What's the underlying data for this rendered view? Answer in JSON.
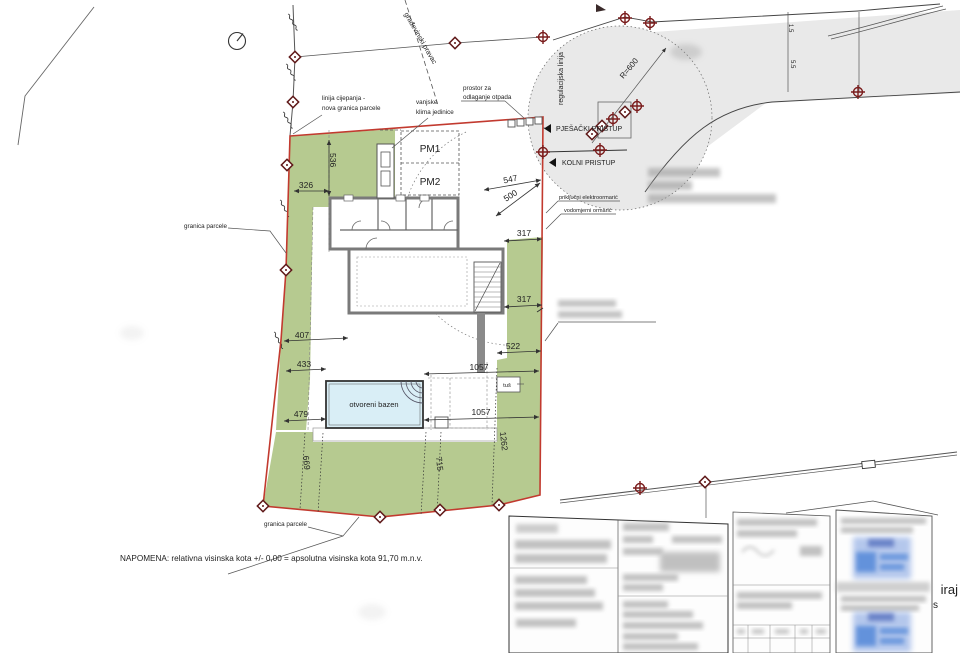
{
  "labels": {
    "split1": "linija cijepanja -",
    "split2": "nova granica parcele",
    "hvac1": "vanjske",
    "hvac2": "klima jedinice",
    "waste1": "prostor za",
    "waste2": "odlaganje otpada",
    "boundary_left": "granica parcele",
    "boundary_bottom": "granica parcele",
    "regulation_line": "regulacijska linija",
    "building_line": "građevinski pravac",
    "radius": "R=600",
    "pedestrian_access": "PJEŠAČKI PRISTUP",
    "vehicle_access": "KOLNI PRISTUP",
    "electric_cabinet": "priključni elektroormarić",
    "water_meter": "vodomjerni ormarić",
    "pm1": "PM1",
    "pm2": "PM2",
    "pool": "otvoreni bazen",
    "shower": "tuš",
    "note": "NAPOMENA: relativna visinska kota  +/- 0,00 = apsolutna visinska kota 91,70 m.n.v.",
    "watermark1": "iraj",
    "watermark2": "u pos"
  },
  "dimensions": {
    "d326": "326",
    "d536": "536",
    "d547": "547",
    "d500": "500",
    "d317_upper": "317",
    "d317_lower": "317",
    "d522": "522",
    "d407": "407",
    "d433": "433",
    "d1057_upper": "1057",
    "d479": "479",
    "d1057_lower": "1057",
    "d1262": "1262",
    "d715": "715",
    "d669": "669",
    "road_width_1": "1.5",
    "road_width_2": "5.5"
  },
  "colors": {
    "parcel_boundary": "#c23a2f",
    "green_area": "#b6ca90",
    "road_fill": "#e9e9e9",
    "pool_fill": "#d9eef6",
    "marker": "#6b1a1a",
    "stamp_blue": "#5b86d8"
  }
}
